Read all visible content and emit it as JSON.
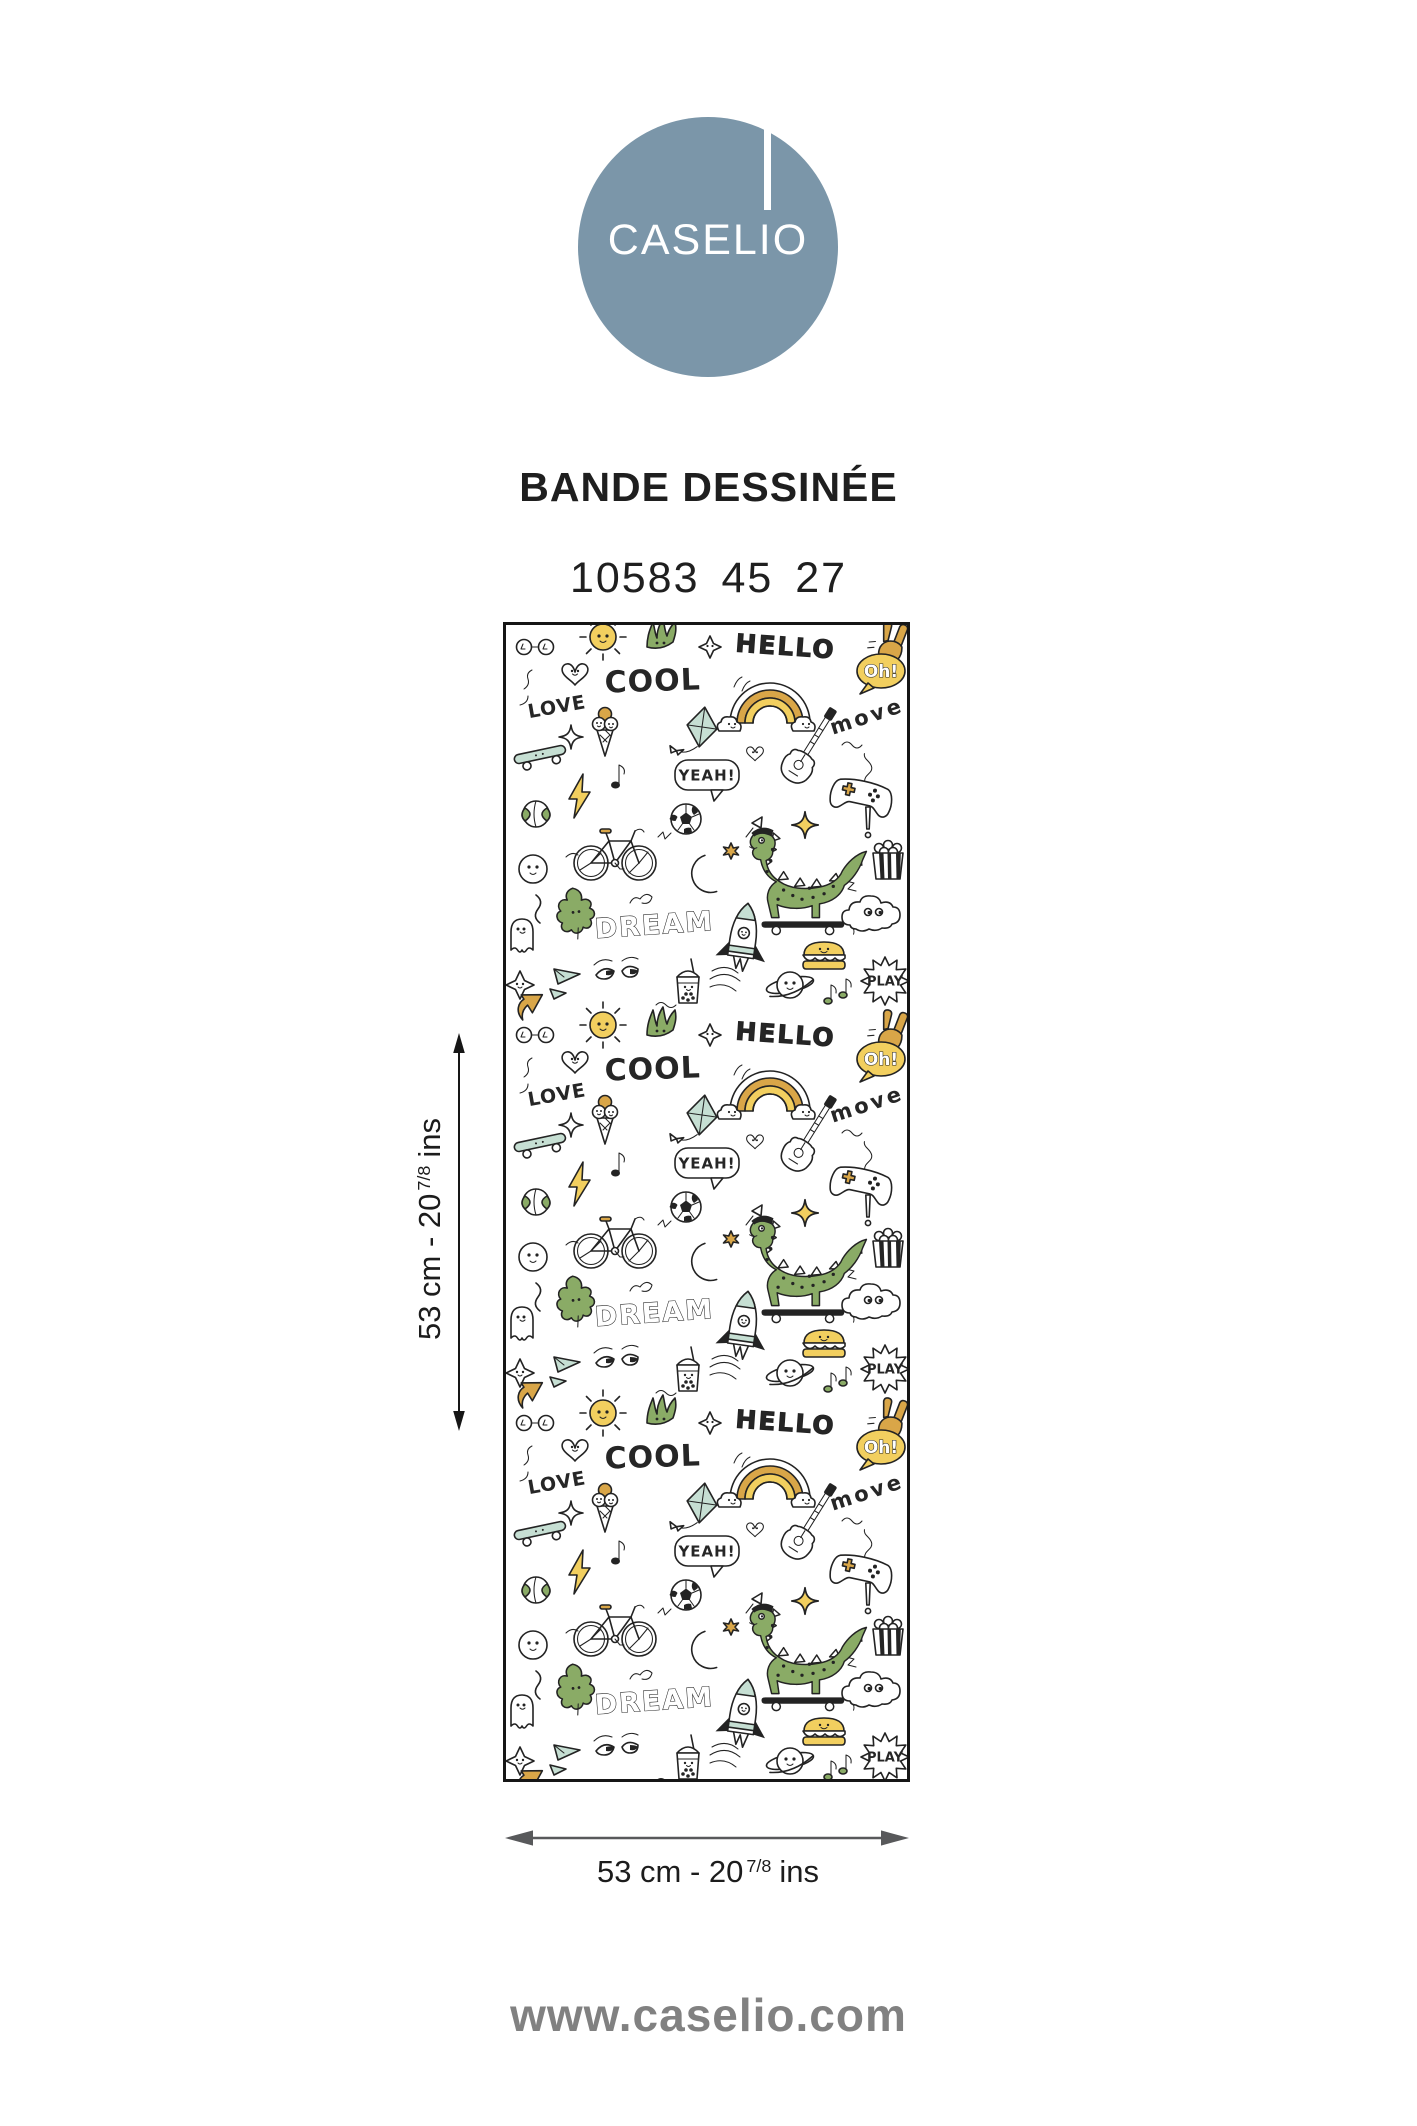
{
  "palette": {
    "logo-blue": "#7b96a9",
    "ink": "#1f1f1f",
    "gray-text": "#818181",
    "arrow-gray": "#58595b",
    "outline": "#232323",
    "doodle-green": "#8aab66",
    "doodle-mint": "#c6dfd3",
    "doodle-yellow": "#f2cf5f",
    "doodle-ochre": "#d9a648"
  },
  "brand": {
    "logo_text": "CASELIO"
  },
  "product": {
    "collection": "BANDE DESSINÉE",
    "reference": "10583 45 27"
  },
  "swatch": {
    "words": {
      "hello": "HELLO",
      "cool": "COOL",
      "love": "LOVE",
      "oh": "Oh!",
      "move": "move",
      "yeah": "YEAH!",
      "dream": "DREAM",
      "play": "PLAY"
    },
    "motifs": [
      "rainbow",
      "dinosaur-on-skateboard",
      "bicycle",
      "guitar",
      "game-controller",
      "soccer-ball",
      "basketball",
      "skateboard",
      "ice-cream",
      "kite",
      "lightning-bolt",
      "moon",
      "sparkle-stars",
      "popcorn",
      "rocket",
      "cloud",
      "burger",
      "ghost",
      "leaf",
      "sun",
      "grass",
      "doodle-eyes",
      "bubble-tea",
      "saturn",
      "music-notes",
      "peace-hand",
      "paper-plane",
      "arrow",
      "hearts",
      "glasses",
      "speech-bubbles"
    ]
  },
  "dimensions": {
    "vertical": {
      "value": "53 cm - 20",
      "fraction": "7/8",
      "unit": "ins"
    },
    "horizontal": {
      "value": "53 cm - 20",
      "fraction": "7/8",
      "unit": "ins"
    }
  },
  "footer": {
    "website": "www.caselio.com"
  }
}
